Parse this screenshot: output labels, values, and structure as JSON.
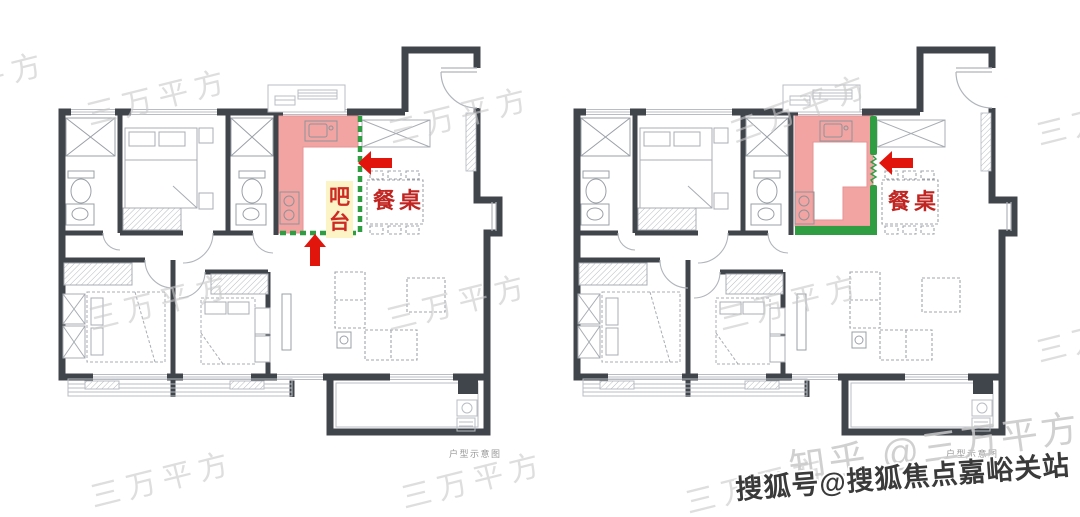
{
  "canvas": {
    "width": 1080,
    "height": 517,
    "background": "#ffffff"
  },
  "colors": {
    "wall": "#40454c",
    "line_light": "#b9bdc3",
    "highlight_pink": "#f2a4a2",
    "pink_border": "#e59392",
    "green": "#2f9e43",
    "arrow_red": "#e2150d",
    "label_red": "#cc2a22",
    "dining_red": "#c02521",
    "bar_bg": "#fcf3c6",
    "watermark_gray": "#c9c9c9",
    "sohu_text": "#3a3a3a",
    "caption_gray": "#999999"
  },
  "plans": {
    "left": {
      "caption": "户型示意图",
      "kitchen_boundary": "dashed",
      "labels": {
        "bar": "吧台",
        "bar_chars": [
          "吧",
          "台"
        ],
        "dining": "餐桌"
      }
    },
    "right": {
      "caption": "户型示意图",
      "kitchen_boundary": "solid",
      "labels": {
        "dining": "餐桌"
      }
    }
  },
  "watermarks": {
    "diagonal": "三万平方",
    "zhihu": "知乎 @三万平方",
    "sohu": "搜狐号@搜狐焦点嘉峪关站"
  }
}
